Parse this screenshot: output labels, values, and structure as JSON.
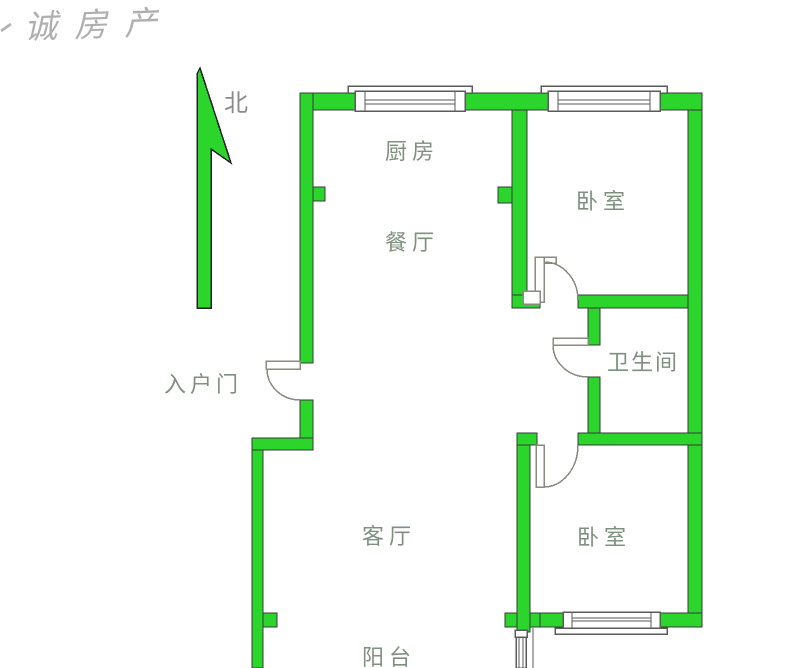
{
  "watermark": {
    "text": "诚房产"
  },
  "compass": {
    "north_label": "北"
  },
  "rooms": {
    "kitchen": {
      "label": "厨房"
    },
    "dining": {
      "label": "餐厅"
    },
    "bedroom1": {
      "label": "卧室"
    },
    "bathroom": {
      "label": "卫生间"
    },
    "entrance": {
      "label": "入户门"
    },
    "living": {
      "label": "客厅"
    },
    "bedroom2": {
      "label": "卧室"
    },
    "balcony": {
      "label": "阳台"
    }
  },
  "colors": {
    "wall": "#2bd52b",
    "wall_outline": "#3a3a3a",
    "label": "#7e907e",
    "watermark": "#9c9c9c",
    "window_line": "#5a5a5a"
  }
}
